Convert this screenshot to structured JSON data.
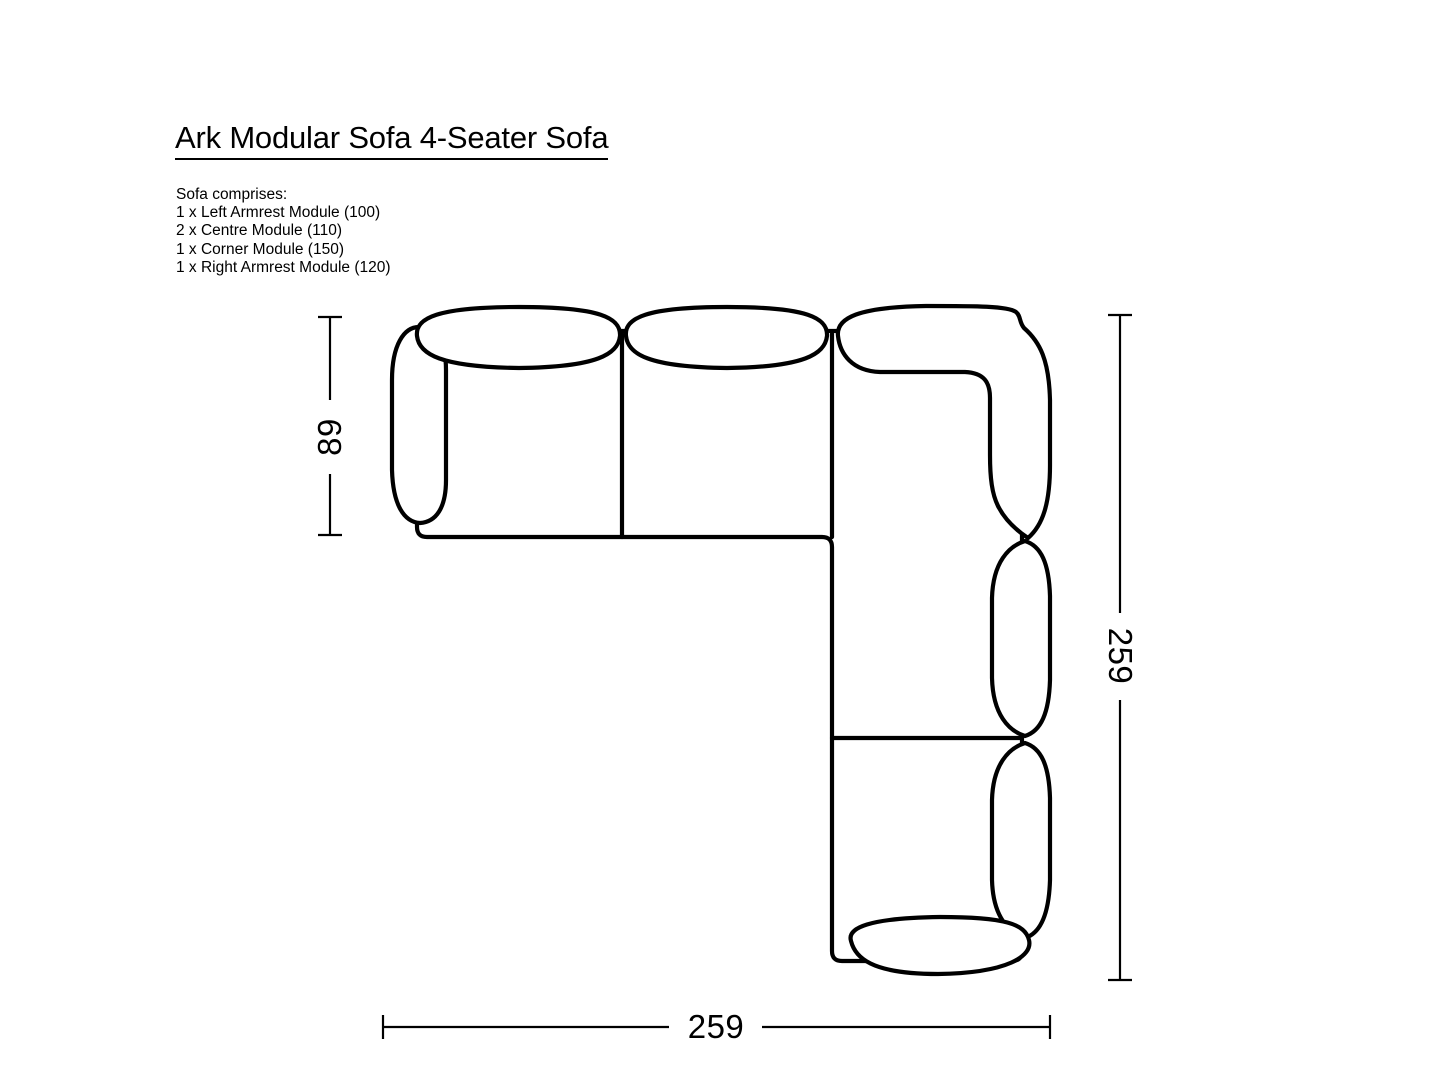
{
  "title": "Ark Modular Sofa 4-Seater Sofa",
  "composition": {
    "heading": "Sofa comprises:",
    "items": [
      "1 x Left Armrest Module (100)",
      "2 x Centre Module (110)",
      "1 x Corner Module (150)",
      "1 x Right Armrest Module (120)"
    ]
  },
  "dimensions": {
    "module_depth": "89",
    "total_depth": "259",
    "total_width": "259"
  },
  "colors": {
    "line": "#000000",
    "background": "#ffffff"
  }
}
